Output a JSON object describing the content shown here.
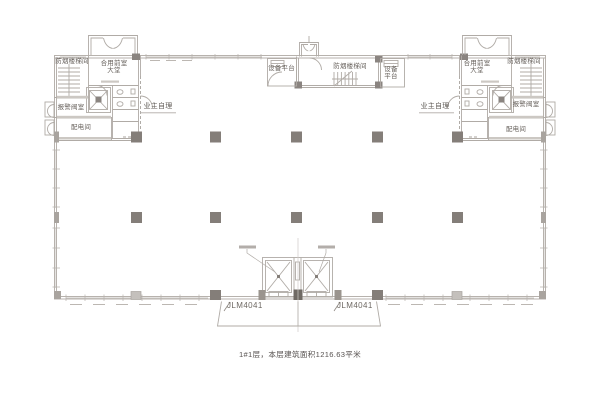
{
  "drawing": {
    "caption": "1#1层，本层建筑面积1216.63平米",
    "labels": {
      "smoke_staircase": "防烟楼梯间",
      "shared_front_room": "合用前室",
      "lobby": "大堂",
      "alarm_valve_room": "报警阀室",
      "power_distribution_room": "配电间",
      "owner_self_managed": "业主自理",
      "equipment_platform": "设备平台",
      "entrance_door_code": "JLM4041"
    },
    "colors": {
      "wall_line": "#b7b2ad",
      "dark_line": "#8f8983",
      "column_fill": "#847e79",
      "text": "#655f5a"
    }
  }
}
